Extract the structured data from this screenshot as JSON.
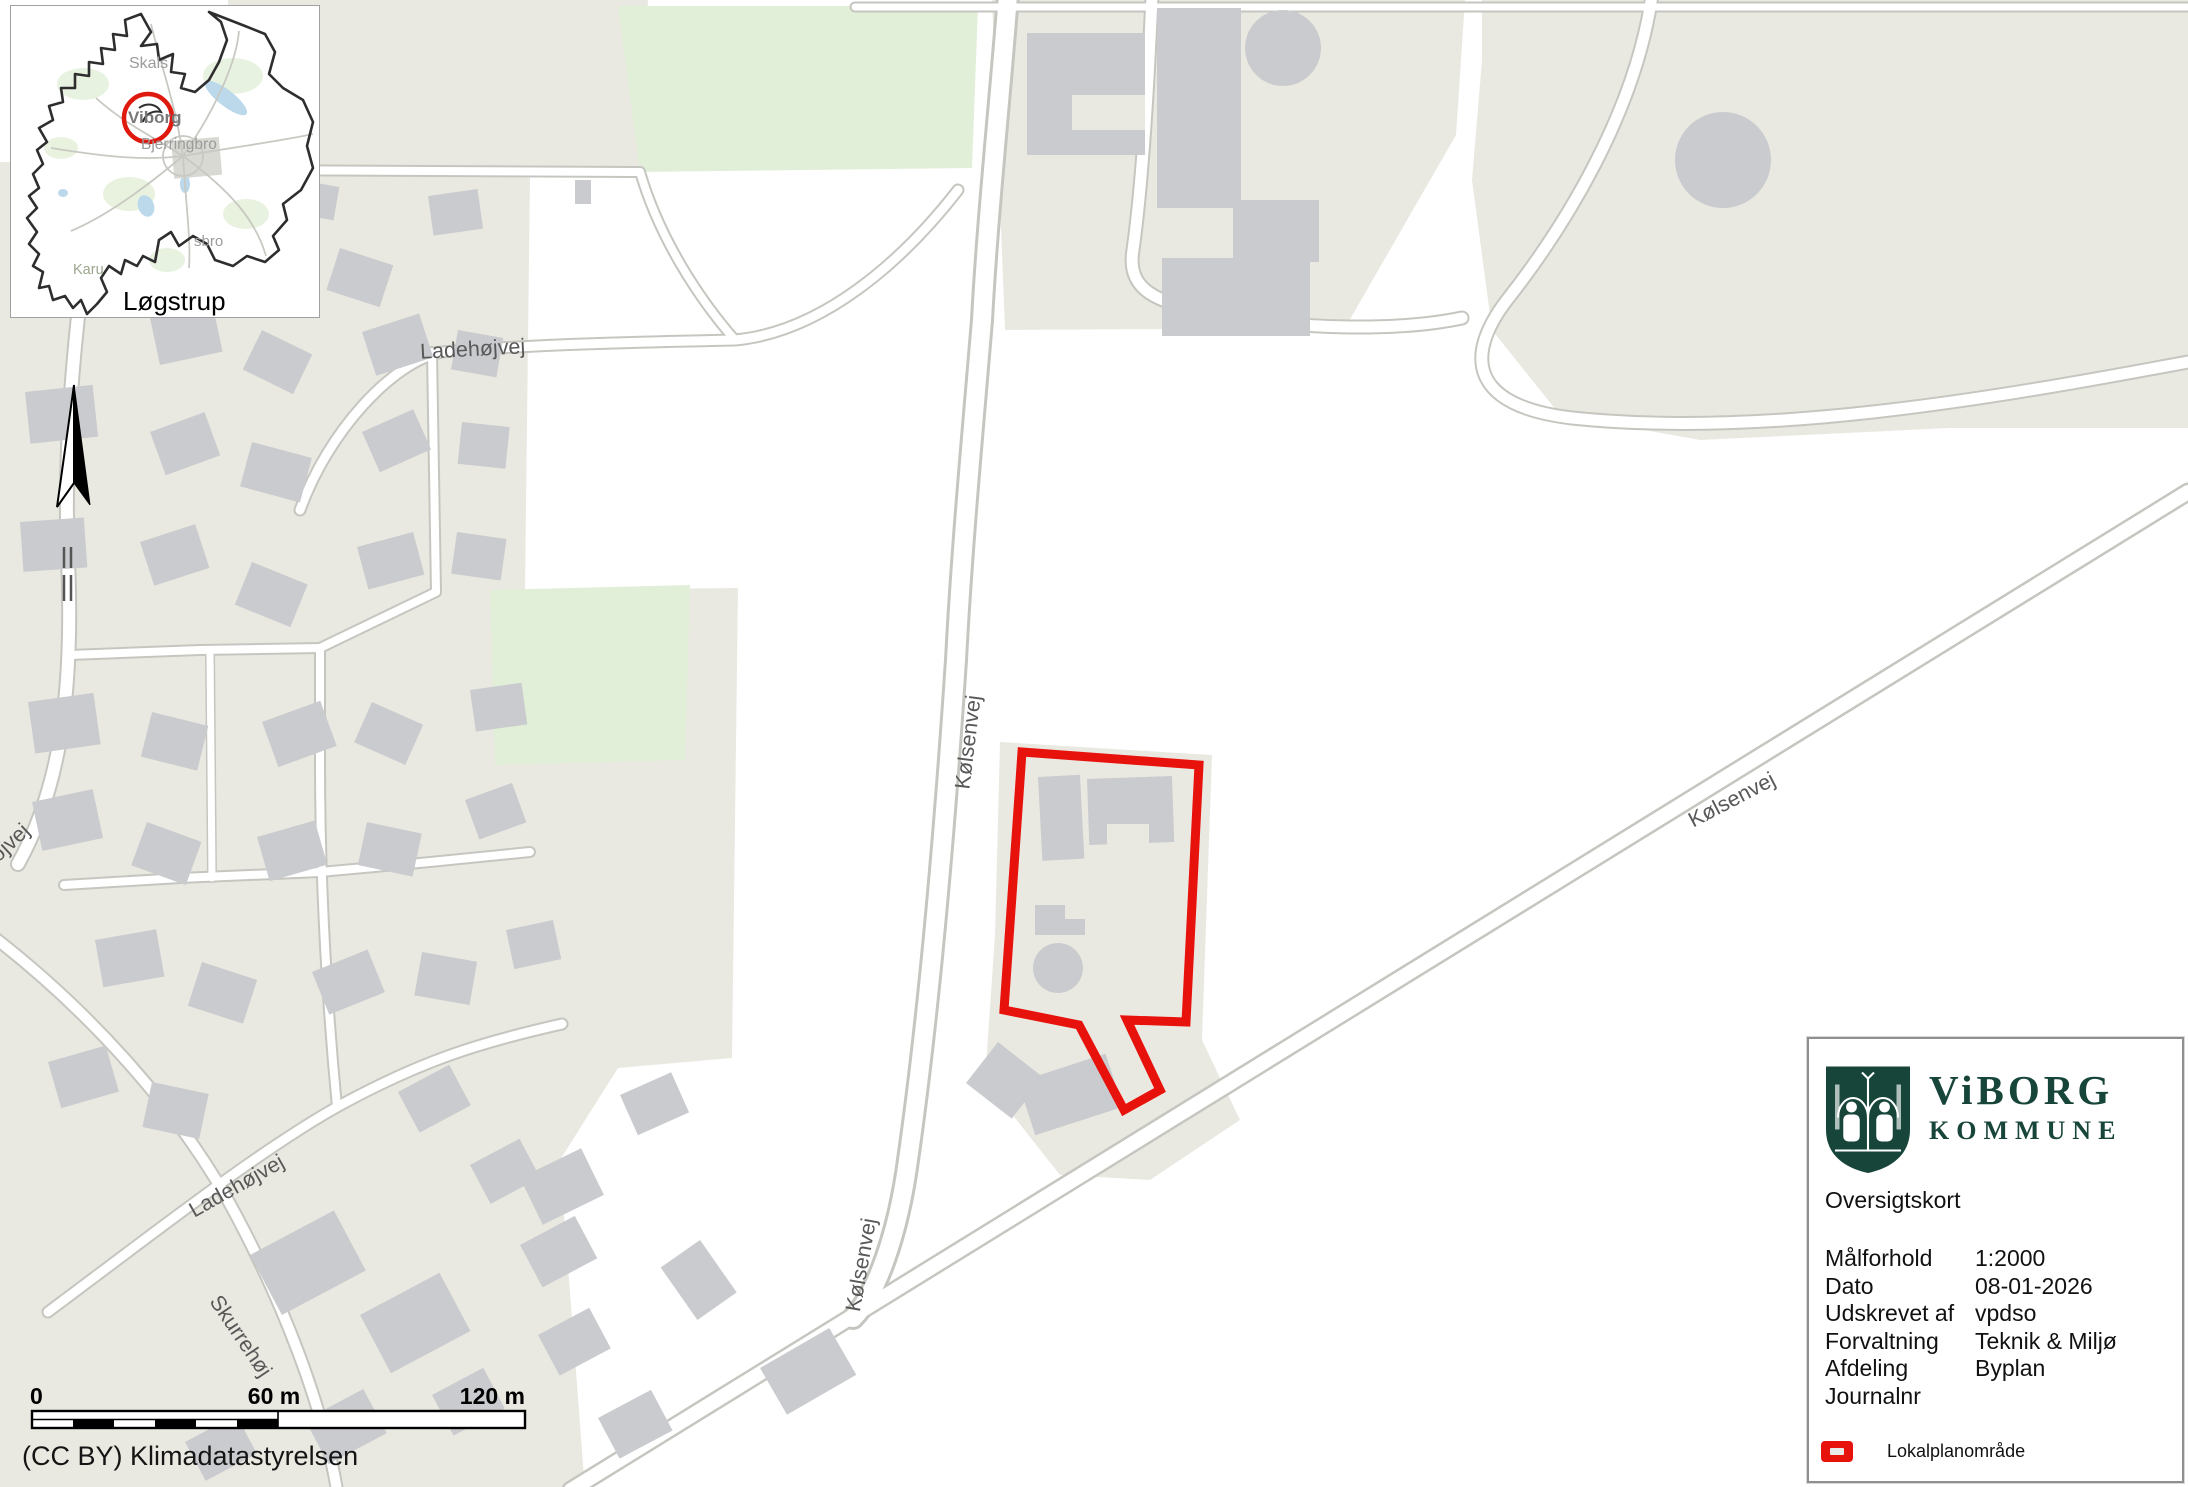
{
  "inset": {
    "town_label": "Løgstrup",
    "labels": {
      "skals": "Skals",
      "viborg": "Viborg",
      "bjerringbro": "Bjerringbro",
      "sbro_partial": "sbro",
      "karup_partial": "Karu"
    }
  },
  "streets": {
    "ladehojvej_top": "Ladehøjvej",
    "ladehojvej_bottom": "Ladehøjvej",
    "skurrehoj": "Skurrehøj",
    "kolsenvej_vertical": "Kølsenvej",
    "kolsenvej_diagonal": "Kølsenvej",
    "kolsenvej_lower": "Kølsenvej",
    "hojvej_partial": "højvej"
  },
  "scalebar": {
    "t0": "0",
    "t60": "60 m",
    "t120": "120 m"
  },
  "attribution": "(CC BY) Klimadatastyrelsen",
  "legend": {
    "brand_line1": "ViBORG",
    "brand_line2": "KOMMUNE",
    "map_title": "Oversigtskort",
    "rows": [
      {
        "label": "Målforhold",
        "value": "1:2000"
      },
      {
        "label": "Dato",
        "value": "08-01-2026"
      },
      {
        "label": "Udskrevet af",
        "value": "vpdso"
      },
      {
        "label": "Forvaltning",
        "value": "Teknik & Miljø"
      },
      {
        "label": "Afdeling",
        "value": "Byplan"
      },
      {
        "label": "Journalnr",
        "value": ""
      }
    ],
    "legend_item_label": "Lokalplanområde"
  },
  "colors": {
    "plan_red": "#e8120d",
    "brand_green": "#17453a",
    "building_gray": "#c9cbce",
    "block_beige": "#eae9e1",
    "green_area": "#e2efd8",
    "road_casing": "#c6c6c0"
  }
}
